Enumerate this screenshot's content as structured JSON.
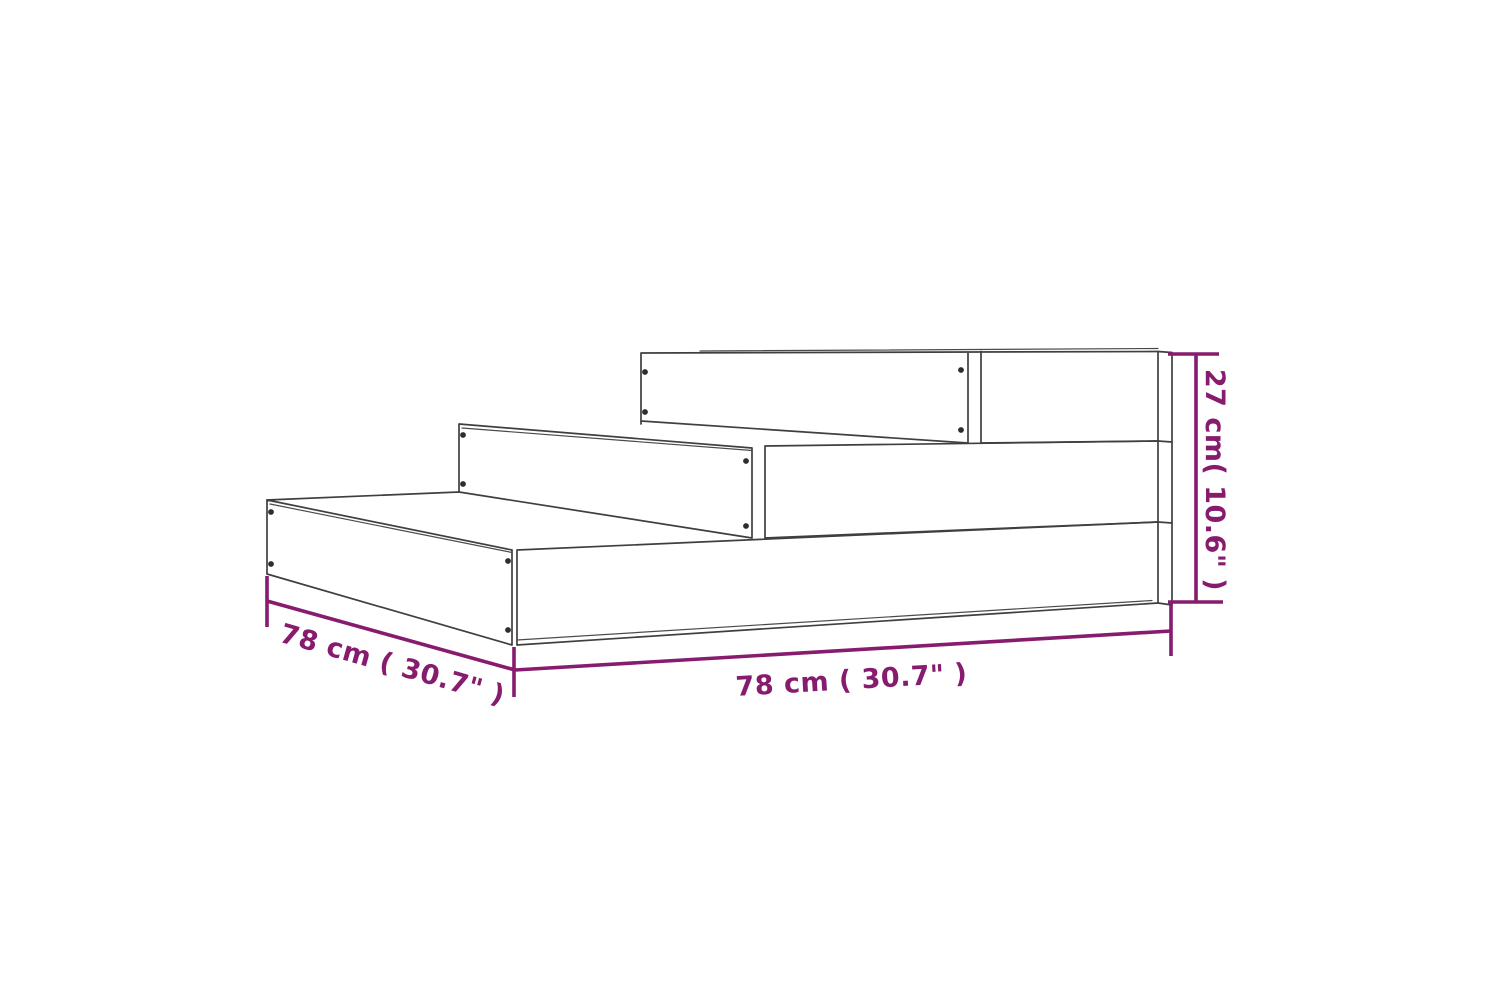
{
  "diagram": {
    "kind": "product-dimension-line-drawing",
    "object": "three-tier-stepped-planter",
    "labels": {
      "depth_left": "78 cm ( 30.7\" )",
      "width_front": "78 cm ( 30.7\" )",
      "height_right": "27 cm( 10.6\" )"
    },
    "colors": {
      "dimension_accent": "#871c6f",
      "outline": "#3f3f3f",
      "background": "#ffffff"
    }
  }
}
